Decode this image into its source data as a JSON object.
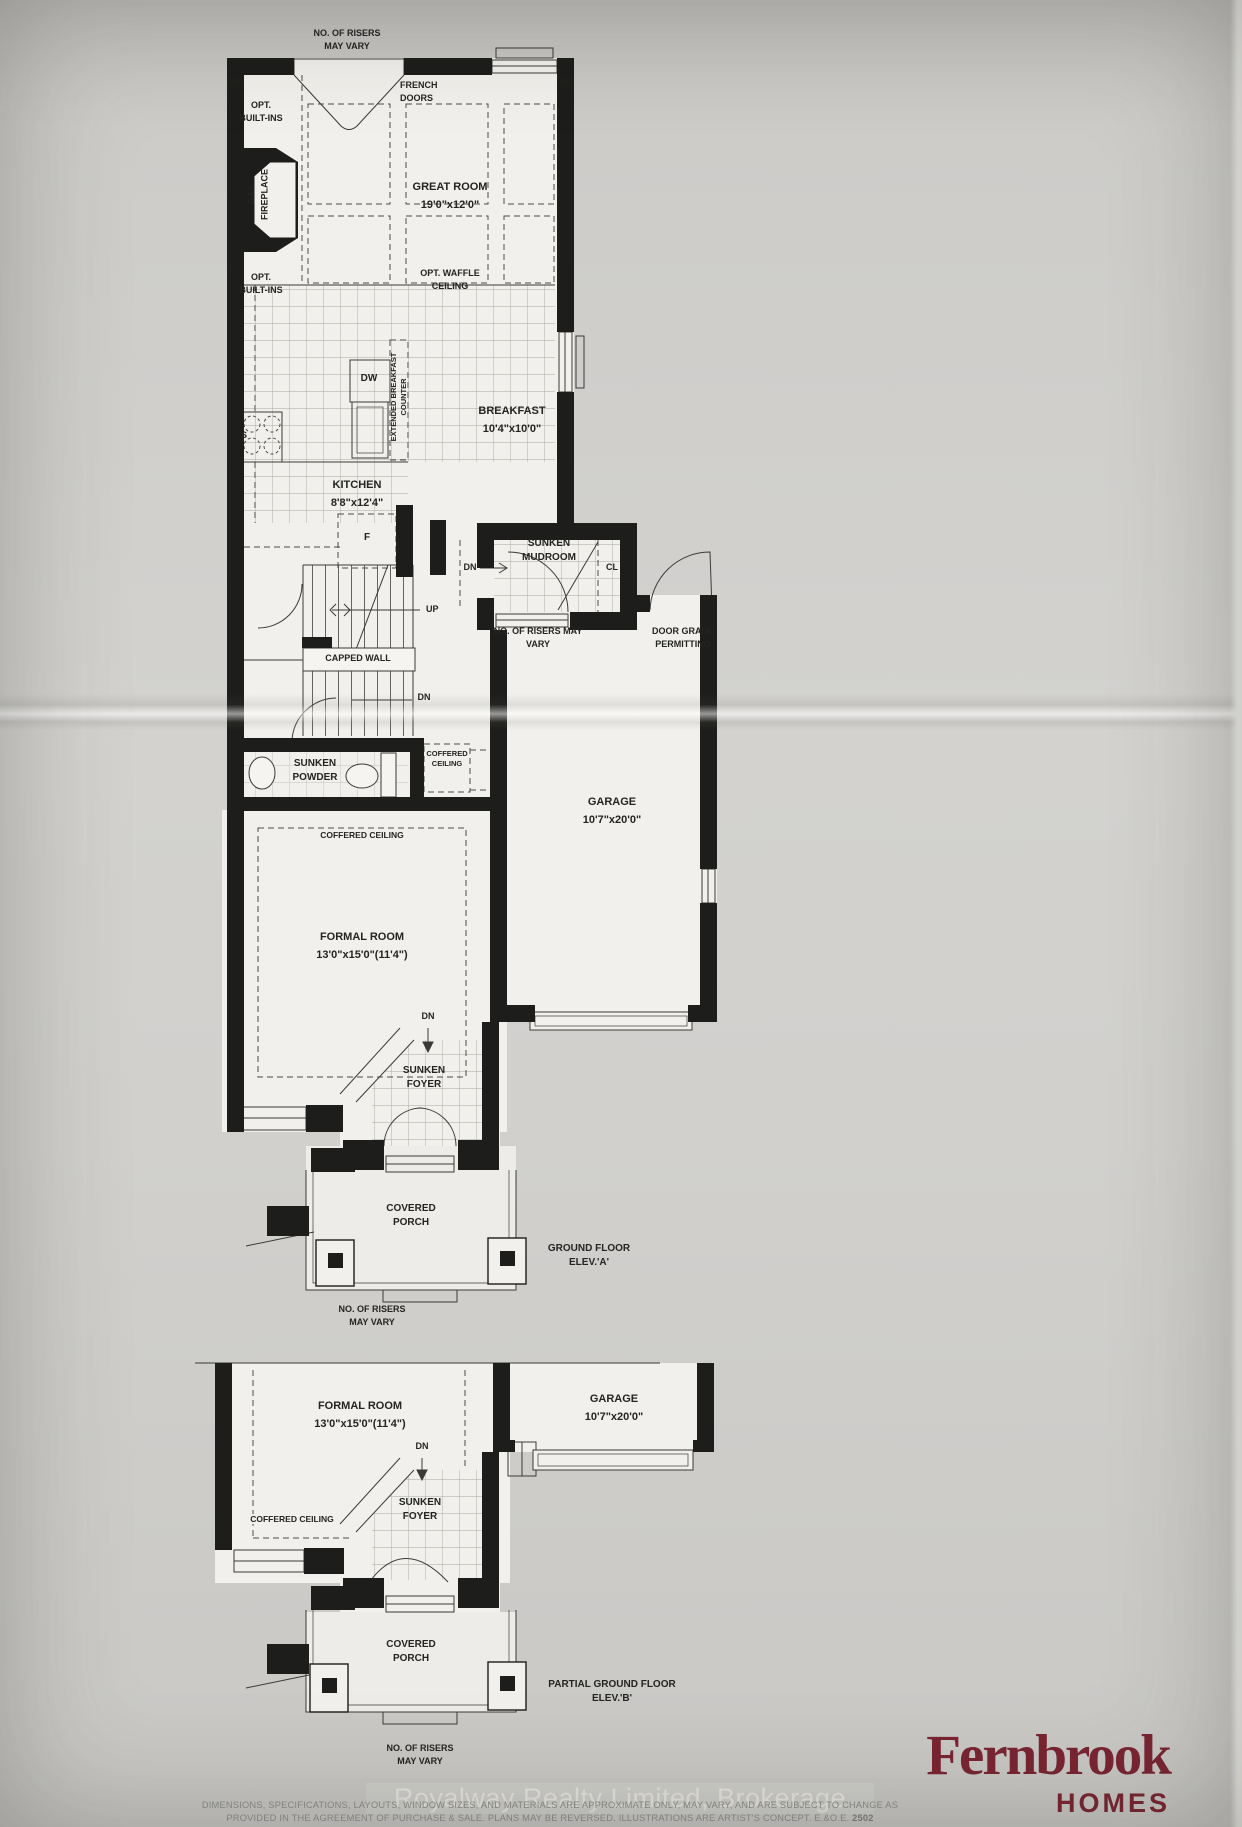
{
  "plan_a": {
    "title": "GROUND FLOOR\nELEV.'A'",
    "rooms": {
      "great_room": {
        "name": "GREAT ROOM",
        "dims": "19'0\"x12'0\""
      },
      "breakfast": {
        "name": "BREAKFAST",
        "dims": "10'4\"x10'0\""
      },
      "kitchen": {
        "name": "KITCHEN",
        "dims": "8'8\"x12'4\""
      },
      "garage": {
        "name": "GARAGE",
        "dims": "10'7\"x20'0\""
      },
      "formal_room": {
        "name": "FORMAL ROOM",
        "dims": "13'0\"x15'0\"(11'4\")"
      },
      "mudroom": "SUNKEN\nMUDROOM",
      "powder": "SUNKEN\nPOWDER",
      "foyer": "SUNKEN\nFOYER",
      "porch": "COVERED\nPORCH"
    },
    "notes": {
      "risers_top": "NO. OF RISERS\nMAY VARY",
      "french_doors": "FRENCH\nDOORS",
      "opt_built_ins": "OPT.\nBUILT-INS",
      "gas_fireplace": "GAS\nFIREPLACE",
      "opt_waffle_ceiling": "OPT. WAFFLE\nCEILING",
      "extended_breakfast_counter": "EXTENDED BREAKFAST\nCOUNTER",
      "appliance_dw": "DW",
      "appliance_s": "S",
      "appliance_f": "F",
      "dn": "DN",
      "up": "UP",
      "cl": "CL",
      "capped_wall": "CAPPED WALL",
      "risers_garage": "NO. OF RISERS MAY\nVARY",
      "door_grade": "DOOR GRADE\nPERMITTING",
      "coffered_ceiling_small": "COFFERED\nCEILING",
      "coffered_ceiling": "COFFERED CEILING",
      "risers_porch": "NO. OF RISERS\nMAY VARY"
    }
  },
  "plan_b": {
    "title": "PARTIAL GROUND FLOOR\nELEV.'B'",
    "rooms": {
      "formal_room": {
        "name": "FORMAL ROOM",
        "dims": "13'0\"x15'0\"(11'4\")"
      },
      "garage": {
        "name": "GARAGE",
        "dims": "10'7\"x20'0\""
      },
      "foyer": "SUNKEN\nFOYER",
      "porch": "COVERED\nPORCH"
    },
    "notes": {
      "dn": "DN",
      "coffered_ceiling": "COFFERED CEILING",
      "risers_porch": "NO. OF RISERS\nMAY VARY"
    }
  },
  "footer": {
    "watermark": "Royalway Realty Limited, Brokerage",
    "disclaimer_line1": "DIMENSIONS, SPECIFICATIONS, LAYOUTS, WINDOW SIZES, AND MATERIALS ARE APPROXIMATE ONLY, MAY VARY, AND ARE SUBJECT TO CHANGE AS",
    "disclaimer_line2": "PROVIDED IN THE AGREEMENT OF PURCHASE & SALE. PLANS MAY BE REVERSED.  ILLUSTRATIONS ARE ARTIST'S CONCEPT. E.&O.E.",
    "plan_number": "2502",
    "brand": {
      "name": "Fernbrook",
      "word": "HOMES",
      "color": "#7a2532"
    }
  }
}
